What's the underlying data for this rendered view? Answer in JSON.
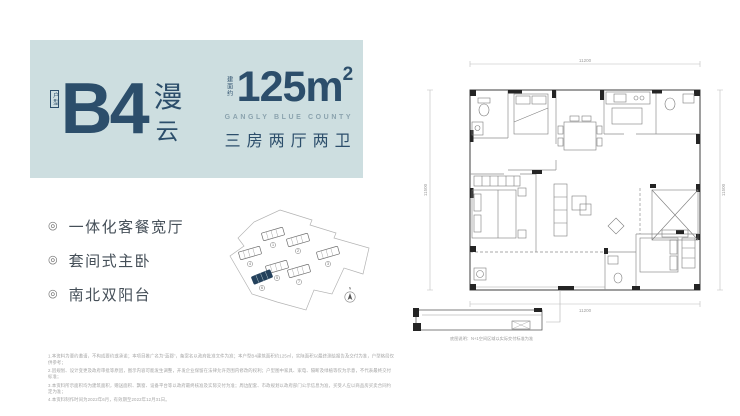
{
  "hero": {
    "unit_tag": "户型",
    "unit_code": "B4",
    "unit_name_top": "漫",
    "unit_name_bottom": "云",
    "area_tag": "建面约",
    "area_value": "125m",
    "area_sup": "2",
    "project_en": "GANGLY BLUE COUNTY",
    "layout_text": "三房两厅两卫"
  },
  "features": {
    "glyph": "◎",
    "items": [
      "一体化客餐宽厅",
      "套间式主卧",
      "南北双阳台"
    ]
  },
  "floor_plan": {
    "dim_top": "11200",
    "dim_bottom": "11200",
    "dim_left": "11500",
    "dim_right": "11500",
    "detail_caption": "底图说明：N+1空间区域以实际交付标准为准"
  },
  "site_plan": {
    "north_label": "N",
    "buildings": [
      "1",
      "2",
      "3",
      "4",
      "5",
      "6",
      "7"
    ]
  },
  "disclaimer": {
    "lines": [
      "1.本资料为要约邀请，不构成要约或承诺；本项目推广名为“蓝郡”，备案名以政府批准文件为准；本户型B4建筑面积约125㎡，实际面积以最终测绘报告及交付为准，户型格局仅供参考；",
      "2.因规划、设计变更及政府审批等原因，图示内容可能发生调整，开发企业保留在法律允许范围内修改的权利；户型图中家具、家电、隔断及绿植等仅为示意，不代表最终交付标准；",
      "3.本资料所示面积均为建筑面积，赠送面积、飘窗、设备平台等以政府最终核准及实际交付为准；周边配套、市政规划以政府部门公示信息为准，买受人应以商品房买卖合同约定为准；",
      "4.本资料制作时间为2022年6月，有效期至2022年12月31日。"
    ]
  },
  "colors": {
    "panel": "#cddee0",
    "navy": "#2c4e6b",
    "subtitle": "#8ba3ae",
    "highlight_building": "#24415c"
  }
}
